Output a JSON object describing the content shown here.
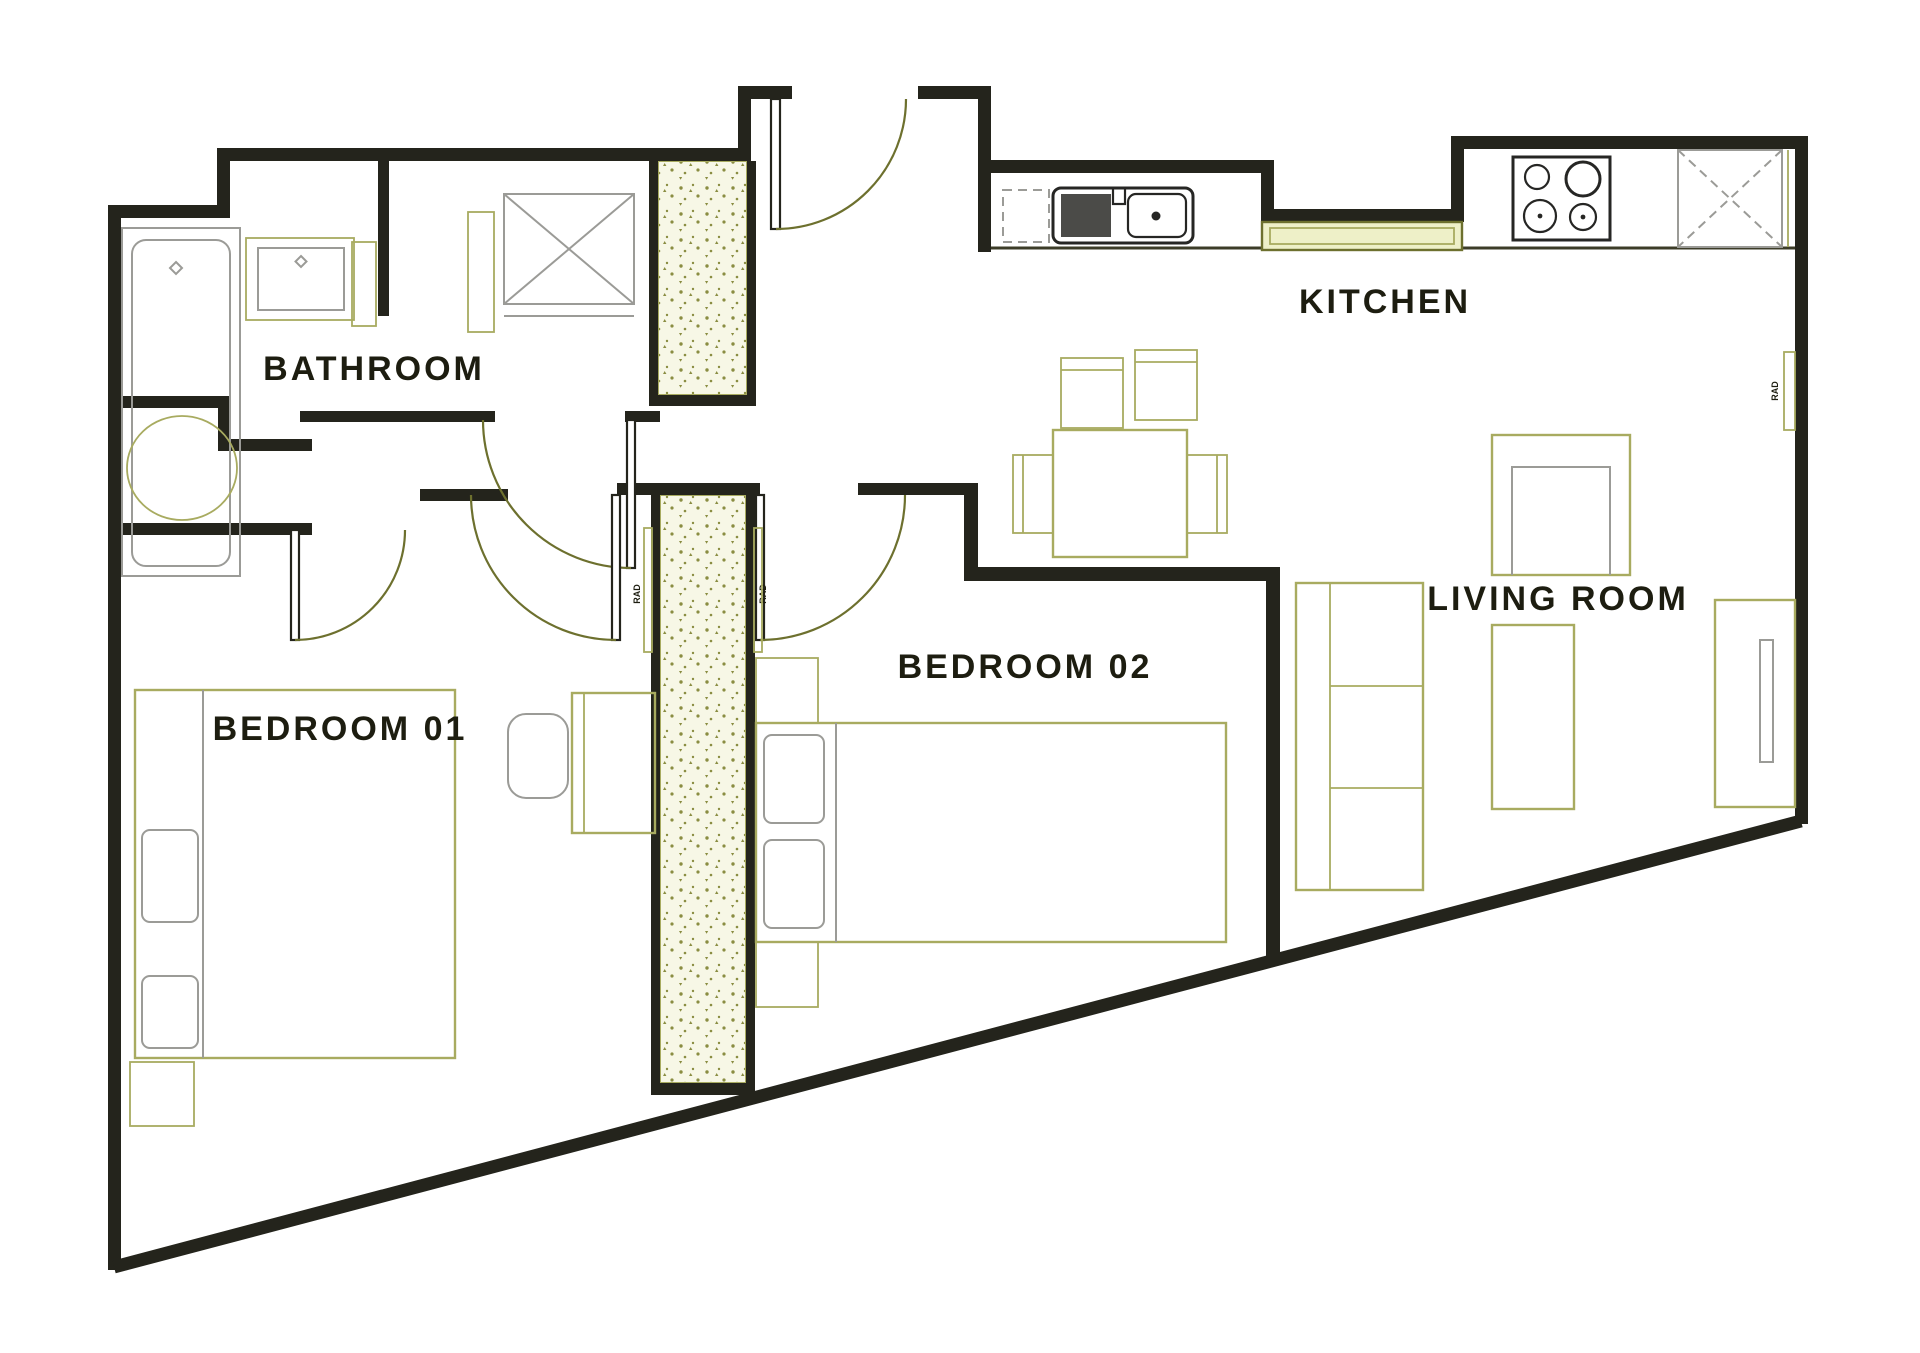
{
  "rooms": {
    "bathroom": {
      "label": "BATHROOM"
    },
    "kitchen": {
      "label": "KITCHEN"
    },
    "living_room": {
      "label": "LIVING ROOM"
    },
    "bedroom_01": {
      "label": "BEDROOM 01"
    },
    "bedroom_02": {
      "label": "BEDROOM 02"
    }
  },
  "radiator_label": "RAD",
  "colors": {
    "wall": "#24241c",
    "furniture": "#a8ab60",
    "olive-dark": "#6d702e",
    "gray": "#9b9b97",
    "hatch-fill": "#f7f7e6",
    "hatch-dot": "#8a8d42",
    "sill": "#eef0c8",
    "label": "#1d1d10",
    "sink-fill": "#4b4b48",
    "sink-stroke": "#262624",
    "counter": "#3c3c28",
    "background": "#ffffff"
  }
}
